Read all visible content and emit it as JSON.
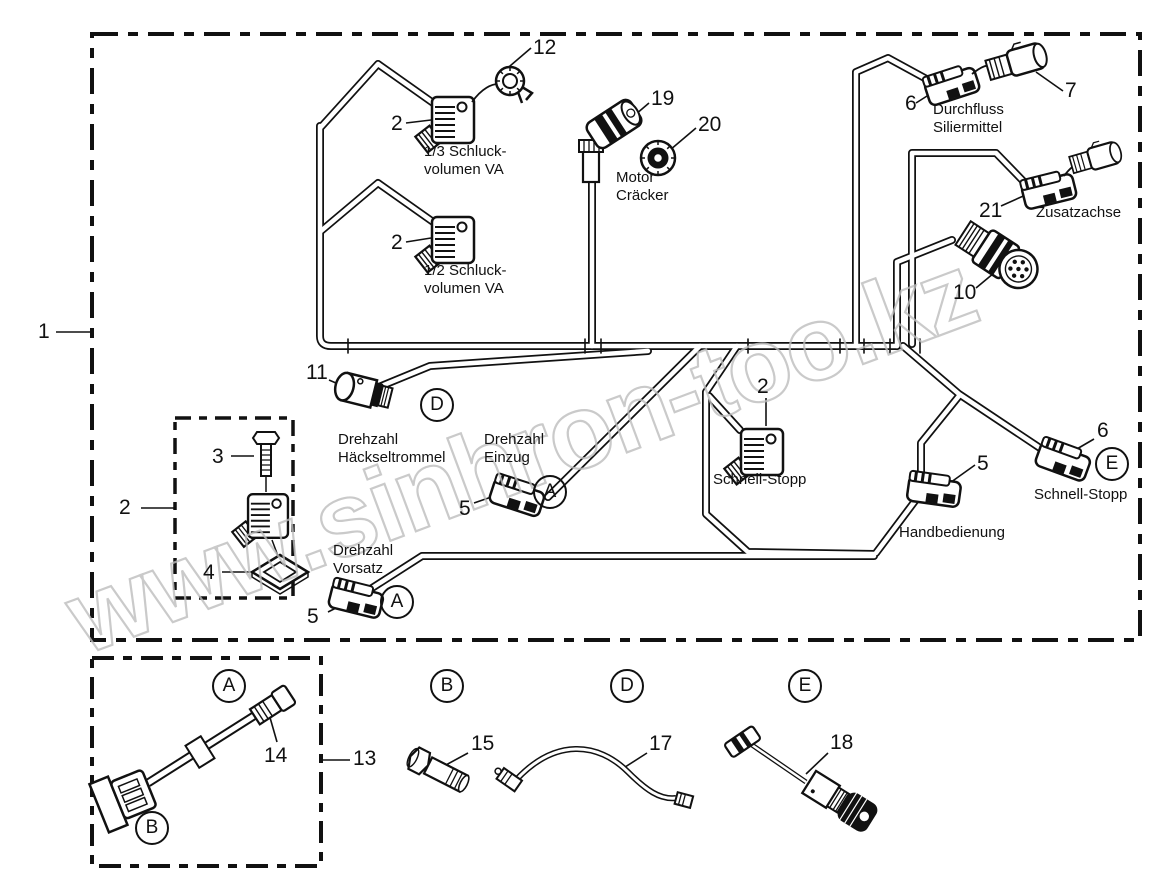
{
  "watermark": "www.sinhron-too.kz",
  "parts": {
    "1": "1",
    "2": "2",
    "3": "3",
    "4": "4",
    "5": "5",
    "6": "6",
    "7": "7",
    "10": "10",
    "11": "11",
    "12": "12",
    "13": "13",
    "14": "14",
    "15": "15",
    "17": "17",
    "18": "18",
    "19": "19",
    "20": "20",
    "21": "21"
  },
  "labels": {
    "schluck13": "1/3 Schluck-\nvolumen VA",
    "schluck12": "1/2 Schluck-\nvolumen VA",
    "motor": "Motor\nCräcker",
    "durchfluss": "Durchfluss\nSiliermittel",
    "zusatzachse": "Zusatzachse",
    "haeckseltrommel": "Drehzahl\nHäckseltrommel",
    "einzug": "Drehzahl\nEinzug",
    "schnellstopp_center": "Schnell-Stopp",
    "vorsatz": "Drehzahl\nVorsatz",
    "handbedienung": "Handbedienung",
    "schnellstopp_right": "Schnell-Stopp"
  },
  "letters": {
    "a": "A",
    "b": "B",
    "d": "D",
    "e": "E"
  }
}
